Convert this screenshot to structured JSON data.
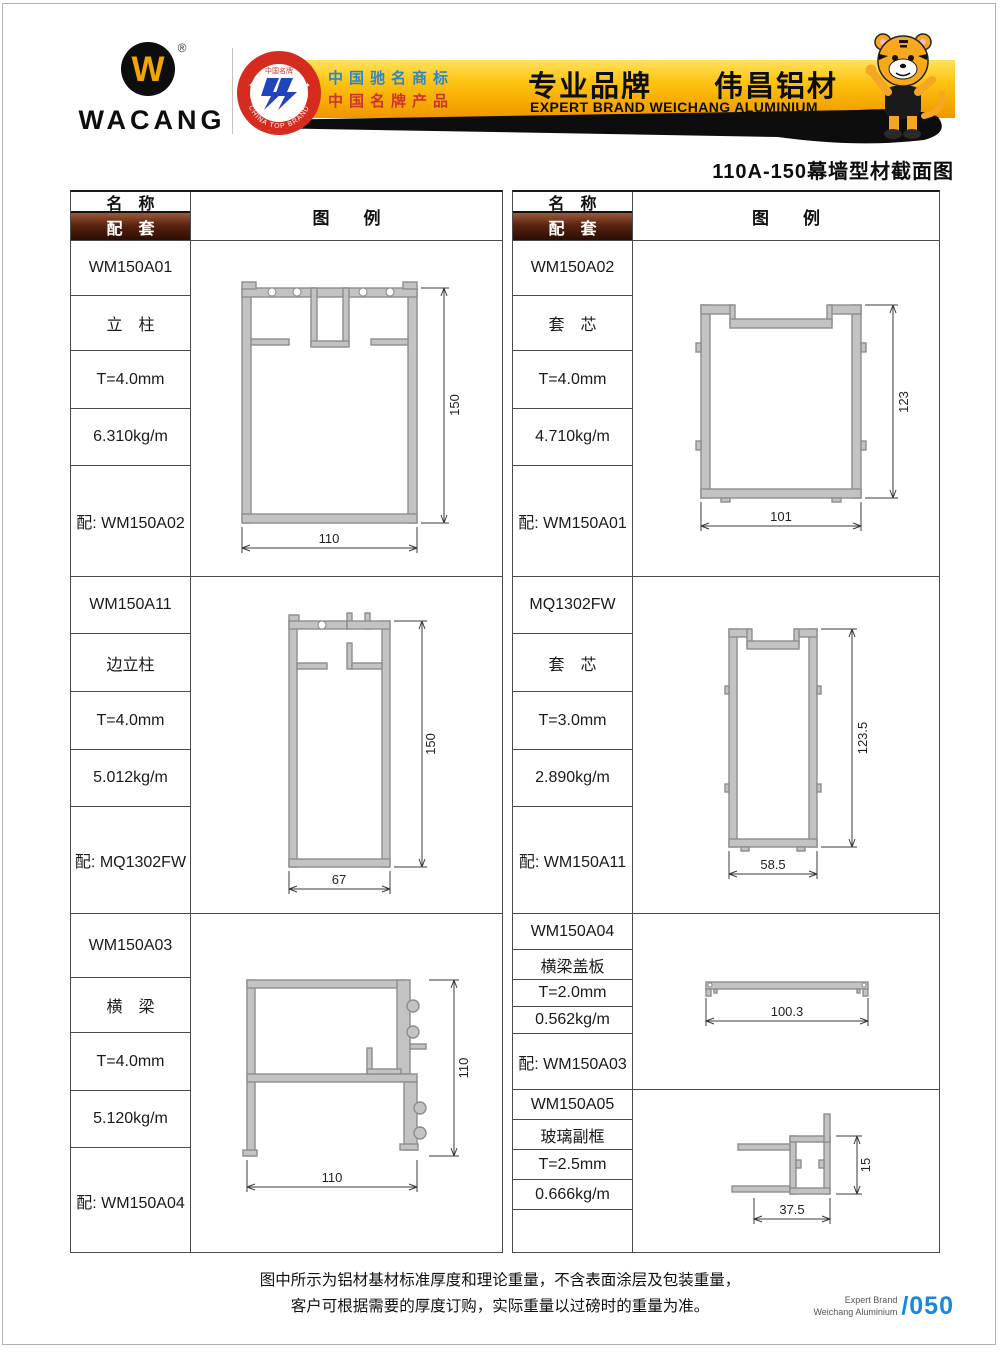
{
  "colors": {
    "banner_gold": "#f7b500",
    "header_bar_brown": "#4a1d0c",
    "page_number_blue": "#1988d8",
    "claim_blue": "#2e86c8",
    "claim_red": "#cc3333",
    "profile_gray": "#c3c3c3"
  },
  "header": {
    "logo": {
      "text": "WACANG",
      "mark": "W",
      "registered": "®"
    },
    "badge": {
      "top_text": "中国名牌",
      "bottom_text": "CHINA TOP BRAND"
    },
    "banner": {
      "claim1": "中国驰名商标",
      "claim2": "中国名牌产品",
      "headline": "专业品牌　　伟昌铝材",
      "subheadline": "EXPERT BRAND WEICHANG ALUMINIUM"
    }
  },
  "page": {
    "title": "110A-150幕墙型材截面图",
    "note_line1": "图中所示为铝材基材标准厚度和理论重量，不含表面涂层及包装重量，",
    "note_line2": "客户可根据需要的厚度订购，实际重量以过磅时的重量为准。",
    "brand_line1": "Expert Brand",
    "brand_line2": "Weichang Aluminium",
    "page_number": "/050"
  },
  "table": {
    "headers": {
      "name": "名　称",
      "pair": "配　套",
      "legend": "图　　例"
    },
    "columns": [
      {
        "sections": [
          {
            "model": "WM150A01",
            "name": "立　柱",
            "thickness": "T=4.0mm",
            "weight": "6.310kg/m",
            "pair": "配: WM150A02",
            "dims": {
              "width": "110",
              "height": "150"
            }
          },
          {
            "model": "WM150A11",
            "name": "边立柱",
            "thickness": "T=4.0mm",
            "weight": "5.012kg/m",
            "pair": "配: MQ1302FW",
            "dims": {
              "width": "67",
              "height": "150"
            }
          },
          {
            "model": "WM150A03",
            "name": "横　梁",
            "thickness": "T=4.0mm",
            "weight": "5.120kg/m",
            "pair": "配: WM150A04",
            "dims": {
              "width": "110",
              "height": "110"
            }
          }
        ]
      },
      {
        "sections": [
          {
            "model": "WM150A02",
            "name": "套　芯",
            "thickness": "T=4.0mm",
            "weight": "4.710kg/m",
            "pair": "配: WM150A01",
            "dims": {
              "width": "101",
              "height": "123"
            }
          },
          {
            "model": "MQ1302FW",
            "name": "套　芯",
            "thickness": "T=3.0mm",
            "weight": "2.890kg/m",
            "pair": "配: WM150A11",
            "dims": {
              "width": "58.5",
              "height": "123.5"
            }
          },
          {
            "model": "WM150A04",
            "name": "横梁盖板",
            "thickness": "T=2.0mm",
            "weight": "0.562kg/m",
            "pair": "配: WM150A03",
            "dims": {
              "width": "100.3"
            }
          },
          {
            "model": "WM150A05",
            "name": "玻璃副框",
            "thickness": "T=2.5mm",
            "weight": "0.666kg/m",
            "pair": "",
            "dims": {
              "width": "37.5",
              "height": "15"
            }
          }
        ]
      }
    ]
  }
}
